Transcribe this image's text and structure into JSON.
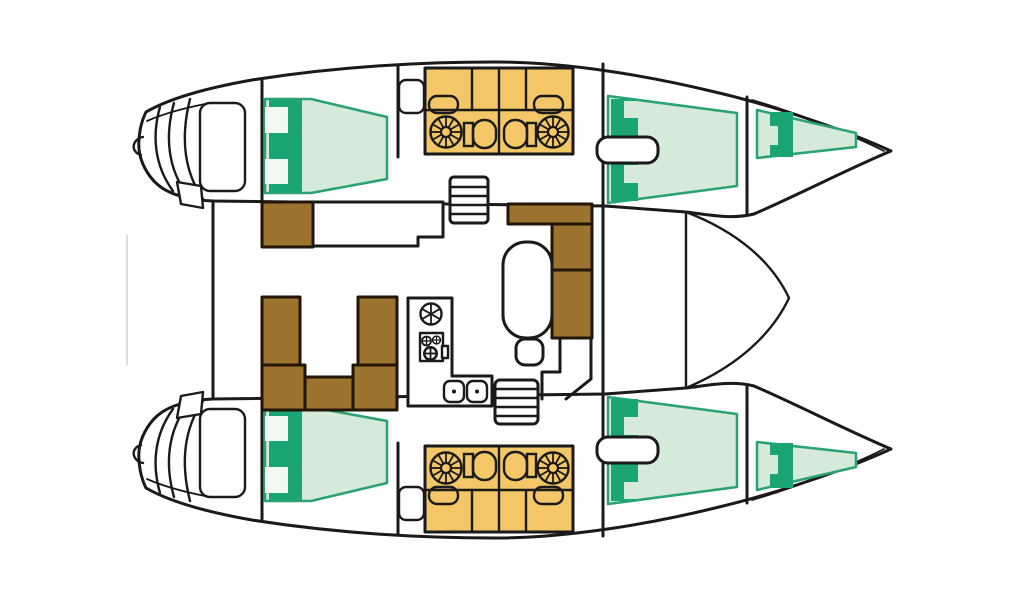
{
  "diagram": {
    "title": "Catamaran yacht interior layout — top-down floor plan",
    "type": "boat-floor-plan",
    "orientation": "bow pointing right",
    "colors": {
      "line": "#1a1a1a",
      "hull_fill": "#ffffff",
      "background": "#ffffff",
      "bed_fill": "#d6ead9",
      "bed_accent": "#1ba474",
      "bed_stroke": "#2aa273",
      "bed_pillow_gap": "#f2f8f2",
      "wet_unit_fill": "#f3c667",
      "furniture_fill": "#9b722e",
      "furniture_stroke": "#231507",
      "beam_faint": "#dcdcdc"
    },
    "regions": {
      "port_hull": "Port hull",
      "starboard_hull": "Starboard hull",
      "aft_cabin_bed": "Aft cabin double berth",
      "head": "Head and shower compartments",
      "fwd_cabin_bed": "Forward cabin double berth",
      "forepeak_berth": "Forepeak berth",
      "transom_steps": "Transom steps and swim platform",
      "saloon": "Saloon",
      "nav_station": "Nav station cabinet",
      "side_counter": "Sideboard counter",
      "port_companionway": "Port companionway steps",
      "starboard_companionway": "Starboard companionway steps",
      "settee": "L-shaped settee",
      "saloon_table": "Saloon table",
      "stool": "Seat / stool",
      "dinette": "U-shaped dinette seating",
      "galley": "Galley worktop",
      "galley_round_sink": "Round sink",
      "galley_stove": "Stove burners",
      "galley_double_sink": "Double sink",
      "foredeck_beam": "Forward crossbeam",
      "walkway": "Cabin entry walkway"
    }
  }
}
